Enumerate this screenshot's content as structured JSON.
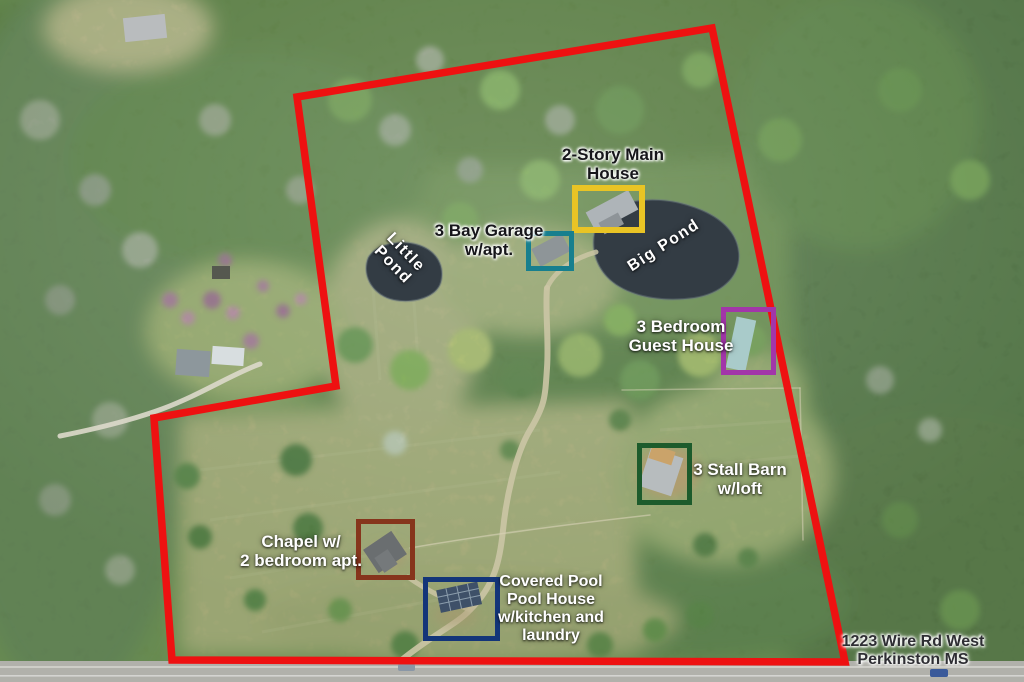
{
  "labels": {
    "main_house": {
      "line1": "2-Story Main",
      "line2": "House"
    },
    "garage": {
      "line1": "3 Bay Garage",
      "line2": "w/apt."
    },
    "little_pond": {
      "line1": "Little",
      "line2": "Pond"
    },
    "big_pond": {
      "text": "Big Pond"
    },
    "guest_house": {
      "line1": "3 Bedroom",
      "line2": "Guest House"
    },
    "barn": {
      "line1": "3 Stall Barn",
      "line2": "w/loft"
    },
    "chapel": {
      "line1": "Chapel w/",
      "line2": "2 bedroom apt."
    },
    "pool_house": {
      "line1": "Covered Pool",
      "line2": "Pool House",
      "line3": "w/kitchen and",
      "line4": "laundry"
    },
    "address": {
      "line1": "1223 Wire Rd West",
      "line2": "Perkinston MS"
    }
  },
  "boxes": {
    "main_house": {
      "color": "#e9c425"
    },
    "garage": {
      "color": "#177f8e"
    },
    "guest_house": {
      "color": "#a236a9"
    },
    "barn": {
      "color": "#1d5b2c"
    },
    "chapel": {
      "color": "#86351c"
    },
    "pool_house": {
      "color": "#133579"
    }
  },
  "boundary": {
    "color": "#ee1111",
    "points": "297,97 712,28 845,662 172,660 154,418 336,386"
  }
}
